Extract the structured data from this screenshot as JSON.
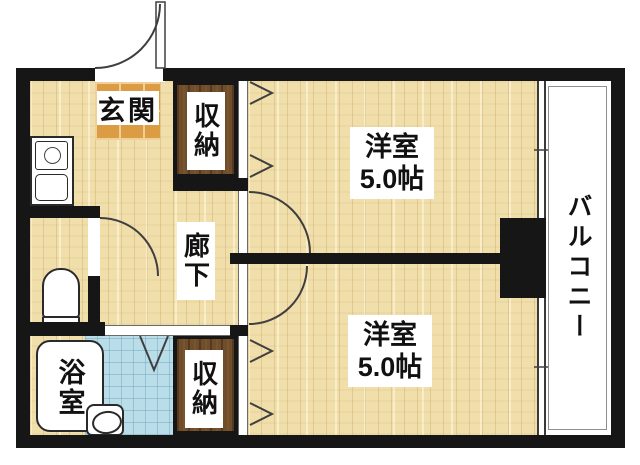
{
  "floorplan": {
    "labels": {
      "genkan": "玄関",
      "closet_top": "収納",
      "closet_bottom": "収納",
      "corridor": "廊下",
      "bath": "浴室",
      "balcony": "バルコニー",
      "room_top": {
        "name": "洋室",
        "size": "5.0帖"
      },
      "room_bottom": {
        "name": "洋室",
        "size": "5.0帖"
      }
    },
    "colors": {
      "wall": "#161616",
      "wood_floor": "#f1dfab",
      "wood_grain": "#c7a45e",
      "closet_wood": "#704d2b",
      "entrance_tile": "#dc9c44",
      "entrance_grout": "#f0cf9a",
      "bath_tile": "#badee9",
      "bath_grid": "#78aabe",
      "balcony_line": "#8f8f8f",
      "door_line": "#3f3f3f"
    }
  }
}
